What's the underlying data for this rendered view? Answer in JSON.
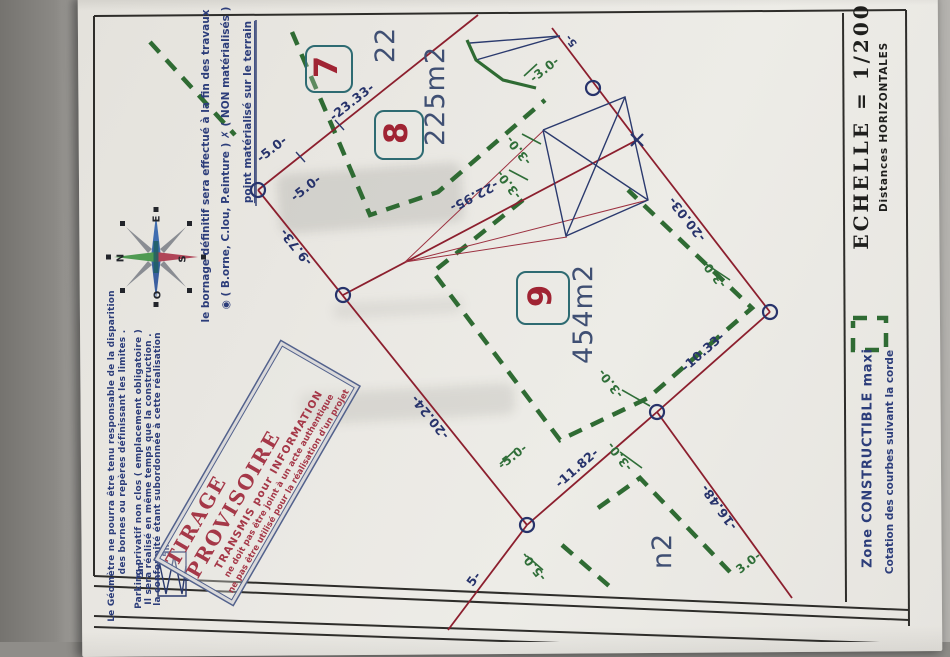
{
  "stamp": {
    "line1": "TIRAGE  PROVISOIRE",
    "line2": "TRANSMIS pour INFORMATION",
    "line3": "ne doit pas être joint à un acte authentique",
    "line4": "ne pas être utilisé pour la réalisation d'un projet"
  },
  "colors": {
    "boundary_red": "#8c1f2e",
    "measure_navy": "#27336b",
    "constructible_green": "#2f6b33",
    "parcel_box_teal": "#2e6b72",
    "parcel_digit_red": "#a02433",
    "area_slate": "#3f4f73",
    "stamp_red": "#a53848",
    "stamp_border_blue": "#52618c",
    "frame_black": "#2e2d2a",
    "paper": "#eae8e3"
  },
  "plan": {
    "boxes": [
      {
        "name": "parcel-7-box",
        "x": 327,
        "y": 67,
        "s": 44
      },
      {
        "name": "parcel-8-box",
        "x": 397,
        "y": 133,
        "s": 46
      },
      {
        "name": "parcel-9-box",
        "x": 541,
        "y": 296,
        "s": 50
      }
    ],
    "labels": [
      {
        "name": "legend-point-title",
        "text": "point matérialisé sur le terrain",
        "x": 249,
        "y": 112,
        "rot": -90,
        "cls": "leg-top u"
      },
      {
        "name": "legend-symbols",
        "text": "◉ ( B.orne, C.lou, P.einture )     ✗ ( NON matérialisés )",
        "x": 227,
        "y": 158,
        "rot": -90,
        "cls": "leg-top"
      },
      {
        "name": "legend-bornage",
        "text": "le bornage définitif sera effectué à la fin des travaux",
        "x": 207,
        "y": 166,
        "rot": -90,
        "cls": "leg-top"
      },
      {
        "name": "compass-n",
        "text": "N",
        "x": 121,
        "y": 258,
        "rot": -90,
        "cls": "comp"
      },
      {
        "name": "compass-e",
        "text": "E",
        "x": 157,
        "y": 219,
        "rot": -90,
        "cls": "comp"
      },
      {
        "name": "compass-s",
        "text": "S",
        "x": 183,
        "y": 259,
        "rot": -90,
        "cls": "comp"
      },
      {
        "name": "compass-o",
        "text": "O",
        "x": 158,
        "y": 295,
        "rot": -90,
        "cls": "comp"
      },
      {
        "name": "note-geometre-1",
        "text": "Le Géomètre ne pourra être tenu responsable de la disparition",
        "x": 112,
        "y": 456,
        "rot": -90,
        "cls": "leg"
      },
      {
        "name": "note-geometre-2",
        "text": "des bornes ou repères définissant les limites .",
        "x": 123,
        "y": 452,
        "rot": -90,
        "cls": "leg"
      },
      {
        "name": "note-parking-1",
        "text": "Parking privatif non clos ( emplacement obligatoire )",
        "x": 139,
        "y": 469,
        "rot": -90,
        "cls": "leg"
      },
      {
        "name": "note-parking-2",
        "text": "Il sera réalisé en même temps que la construction .",
        "x": 149,
        "y": 469,
        "rot": -90,
        "cls": "leg"
      },
      {
        "name": "note-parking-3",
        "text": "la conformité étant subordonnée à cette réalisation",
        "x": 158,
        "y": 469,
        "rot": -90,
        "cls": "leg"
      },
      {
        "name": "parking-scale-label",
        "text": "5m",
        "x": 141,
        "y": 570,
        "rot": -90,
        "cls": "leg"
      },
      {
        "name": "parking-scale-label-2",
        "text": "5m",
        "x": 167,
        "y": 549,
        "rot": -90,
        "cls": "leg"
      },
      {
        "name": "parcel-7-number",
        "text": "7",
        "x": 327,
        "y": 67,
        "rot": -90,
        "cls": "p-num"
      },
      {
        "name": "parcel-8-number",
        "text": "8",
        "x": 397,
        "y": 133,
        "rot": -90,
        "cls": "p-num"
      },
      {
        "name": "parcel-9-number",
        "text": "9",
        "x": 541,
        "y": 296,
        "rot": -90,
        "cls": "p-num"
      },
      {
        "name": "parcel-7-area-partial",
        "text": "22",
        "x": 386,
        "y": 45,
        "rot": -90,
        "cls": "p-area"
      },
      {
        "name": "parcel-8-area",
        "text": "225m2",
        "x": 436,
        "y": 96,
        "rot": -90,
        "cls": "p-area"
      },
      {
        "name": "parcel-9-area",
        "text": "454m2",
        "x": 584,
        "y": 314,
        "rot": -90,
        "cls": "p-area"
      },
      {
        "name": "lower-parcel-area-partial",
        "text": "n2",
        "x": 663,
        "y": 551,
        "rot": -90,
        "cls": "p-area"
      },
      {
        "name": "measure-23-33",
        "text": "-23.33-",
        "x": 352,
        "y": 102,
        "rot": -38,
        "cls": "m-navy"
      },
      {
        "name": "measure-5-0-a",
        "text": "-5.0-",
        "x": 272,
        "y": 149,
        "rot": -38,
        "cls": "m-navy"
      },
      {
        "name": "measure-5-0-b",
        "text": "-5.0-",
        "x": 306,
        "y": 188,
        "rot": -38,
        "cls": "m-navy"
      },
      {
        "name": "measure-9-73",
        "text": "-9.73-",
        "x": 296,
        "y": 247,
        "rot": -129,
        "cls": "m-navy"
      },
      {
        "name": "measure-20-24",
        "text": "-20.24-",
        "x": 430,
        "y": 417,
        "rot": -129,
        "cls": "m-navy"
      },
      {
        "name": "measure-22-95",
        "text": "-22.95-",
        "x": 474,
        "y": 196,
        "rot": 152,
        "cls": "m-navy"
      },
      {
        "name": "measure-20-03",
        "text": "-20.03-",
        "x": 687,
        "y": 219,
        "rot": -128,
        "cls": "m-navy"
      },
      {
        "name": "measure-10-33",
        "text": "-10.33-",
        "x": 703,
        "y": 352,
        "rot": -41,
        "cls": "m-navy"
      },
      {
        "name": "measure-11-82",
        "text": "-11.82-",
        "x": 577,
        "y": 468,
        "rot": -41,
        "cls": "m-navy"
      },
      {
        "name": "measure-16-48",
        "text": "-16.48-",
        "x": 719,
        "y": 507,
        "rot": -126,
        "cls": "m-navy"
      },
      {
        "name": "measure-partial-5",
        "text": "5-",
        "x": 474,
        "y": 579,
        "rot": -53,
        "cls": "m-navy"
      },
      {
        "name": "measure-partial-5-top",
        "text": "5-",
        "x": 572,
        "y": 40,
        "rot": -128,
        "cls": "m-navy sm"
      },
      {
        "name": "setback-3-0-top",
        "text": "-3.0-",
        "x": 545,
        "y": 70,
        "rot": -38,
        "cls": "m-green"
      },
      {
        "name": "setback-3-0-bldg-a",
        "text": "-3.0-",
        "x": 519,
        "y": 150,
        "rot": -128,
        "cls": "m-green"
      },
      {
        "name": "setback-3-0-bldg-b",
        "text": "-3.0-",
        "x": 509,
        "y": 184,
        "rot": -128,
        "cls": "m-green"
      },
      {
        "name": "setback-3-0-right",
        "text": "-3.0-",
        "x": 714,
        "y": 273,
        "rot": -128,
        "cls": "m-green"
      },
      {
        "name": "setback-3-0-mid",
        "text": "-3.0-",
        "x": 611,
        "y": 383,
        "rot": -128,
        "cls": "m-green"
      },
      {
        "name": "setback-3-0-low",
        "text": "-3.0-",
        "x": 620,
        "y": 456,
        "rot": -128,
        "cls": "m-green"
      },
      {
        "name": "setback-5-0-mid",
        "text": "-5.0-",
        "x": 513,
        "y": 457,
        "rot": -38,
        "cls": "m-green"
      },
      {
        "name": "setback-5-0-low",
        "text": "-5.0-",
        "x": 534,
        "y": 566,
        "rot": -128,
        "cls": "m-green"
      },
      {
        "name": "setback-3-0-corner",
        "text": "3.0-",
        "x": 749,
        "y": 563,
        "rot": -38,
        "cls": "m-green"
      },
      {
        "name": "scale-title",
        "text": "ECHELLE  =  1/200",
        "x": 861,
        "y": 126,
        "rot": -90,
        "cls": "echelle"
      },
      {
        "name": "scale-subtitle",
        "text": "Distances  HORIZONTALES",
        "x": 885,
        "y": 127,
        "rot": -90,
        "cls": "dist"
      },
      {
        "name": "zone-legend-title",
        "text": "Zone  CONSTRUCTIBLE  maxi",
        "x": 869,
        "y": 458,
        "rot": -90,
        "cls": "zone1"
      },
      {
        "name": "zone-legend-subtitle",
        "text": "Cotation des courbes suivant la corde",
        "x": 891,
        "y": 462,
        "rot": -90,
        "cls": "zone2"
      }
    ],
    "svg": {
      "groups": [
        {
          "name": "plan-frame-line",
          "stroke": "#2e2d2a",
          "w": 2,
          "lines": [
            [
              94,
              16,
              906,
              10
            ],
            [
              94,
              16,
              94,
              576
            ],
            [
              906,
              10,
              909,
              626
            ],
            [
              843,
              13,
              846,
              602
            ],
            [
              94,
              576,
              909,
              610
            ],
            [
              94,
              586,
              909,
              620
            ],
            [
              94,
              616,
              909,
              644
            ],
            [
              94,
              627,
              909,
              655
            ]
          ]
        },
        {
          "name": "constructible-zone-dash",
          "stroke": "#2f6b33",
          "w": 4.5,
          "dash": "14 10",
          "paths": [
            [
              [
                150,
                42
              ],
              [
                235,
                135
              ]
            ],
            [
              [
                292,
                32
              ],
              [
                370,
                215
              ],
              [
                438,
                192
              ],
              [
                545,
                100
              ]
            ],
            [
              [
                523,
                200
              ],
              [
                433,
                272
              ],
              [
                560,
                440
              ],
              [
                648,
                398
              ],
              [
                752,
                308
              ],
              [
                628,
                190
              ]
            ],
            [
              [
                598,
                508
              ],
              [
                640,
                478
              ],
              [
                730,
                572
              ]
            ],
            [
              [
                562,
                545
              ],
              [
                616,
                592
              ]
            ],
            [
              [
                853,
                318
              ],
              [
                886,
                318
              ],
              [
                886,
                350
              ],
              [
                853,
                350
              ],
              [
                853,
                321
              ]
            ]
          ]
        },
        {
          "name": "boundary-line",
          "stroke": "#8c1f2e",
          "w": 1.8,
          "lines": [
            [
              258,
              190,
              478,
              15
            ],
            [
              258,
              190,
              527,
              525
            ],
            [
              637,
              140,
              770,
              312
            ],
            [
              552,
              28,
              637,
              140
            ],
            [
              527,
              525,
              448,
              630
            ],
            [
              527,
              525,
              657,
              412
            ],
            [
              657,
              412,
              770,
              312
            ],
            [
              343,
              295,
              637,
              140
            ],
            [
              657,
              412,
              792,
              598
            ]
          ]
        },
        {
          "name": "sight-line",
          "stroke": "#9c3140",
          "w": 1,
          "lines": [
            [
              405,
              262,
              543,
              131
            ],
            [
              405,
              262,
              567,
              237
            ],
            [
              405,
              262,
              648,
              200
            ]
          ]
        },
        {
          "name": "building-outline",
          "stroke": "#2b3a6e",
          "w": 1.4,
          "paths": [
            [
              [
                543,
                130
              ],
              [
                625,
                97
              ],
              [
                648,
                200
              ],
              [
                566,
                236
              ],
              [
                543,
                130
              ]
            ],
            [
              [
                470,
                43
              ],
              [
                560,
                36
              ]
            ],
            [
              [
                476,
                60
              ],
              [
                560,
                36
              ]
            ],
            [
              [
                158,
                552
              ],
              [
                186,
                552
              ],
              [
                186,
                596
              ],
              [
                158,
                596
              ],
              [
                158,
                552
              ]
            ],
            [
              [
                158,
                556
              ],
              [
                166,
                594
              ],
              [
                174,
                556
              ],
              [
                182,
                594
              ],
              [
                186,
                566
              ]
            ],
            [
              [
                256,
                20
              ],
              [
                256,
                206
              ]
            ]
          ],
          "lines": [
            [
              543,
              130,
              648,
              200
            ],
            [
              625,
              97,
              566,
              236
            ],
            [
              296,
              152,
              305,
              162
            ],
            [
              335,
              120,
              344,
              130
            ]
          ]
        },
        {
          "name": "slope-arrow",
          "stroke": "#2f6b33",
          "w": 3.2,
          "paths": [
            [
              [
                467,
                40
              ],
              [
                476,
                60
              ],
              [
                503,
                80
              ],
              [
                536,
                88
              ]
            ]
          ]
        },
        {
          "name": "setback-tick",
          "stroke": "#2f6e38",
          "w": 1.6,
          "lines": [
            [
              622,
              390,
              650,
              406
            ],
            [
              620,
              452,
              642,
              468
            ],
            [
              706,
              264,
              730,
              280
            ],
            [
              524,
              76,
              537,
              64
            ],
            [
              522,
              134,
              541,
              144
            ],
            [
              509,
              170,
              528,
              180
            ],
            [
              500,
              464,
              514,
              451
            ],
            [
              527,
              556,
              543,
              570
            ]
          ]
        },
        {
          "name": "survey-point-marker",
          "stroke": "#27336b",
          "w": 2.2,
          "circles": [
            [
              258,
              190
            ],
            [
              343,
              295
            ],
            [
              527,
              525
            ],
            [
              657,
              412
            ],
            [
              770,
              312
            ],
            [
              593,
              88
            ]
          ],
          "xmarks": [
            [
              637,
              140
            ]
          ]
        }
      ]
    }
  }
}
